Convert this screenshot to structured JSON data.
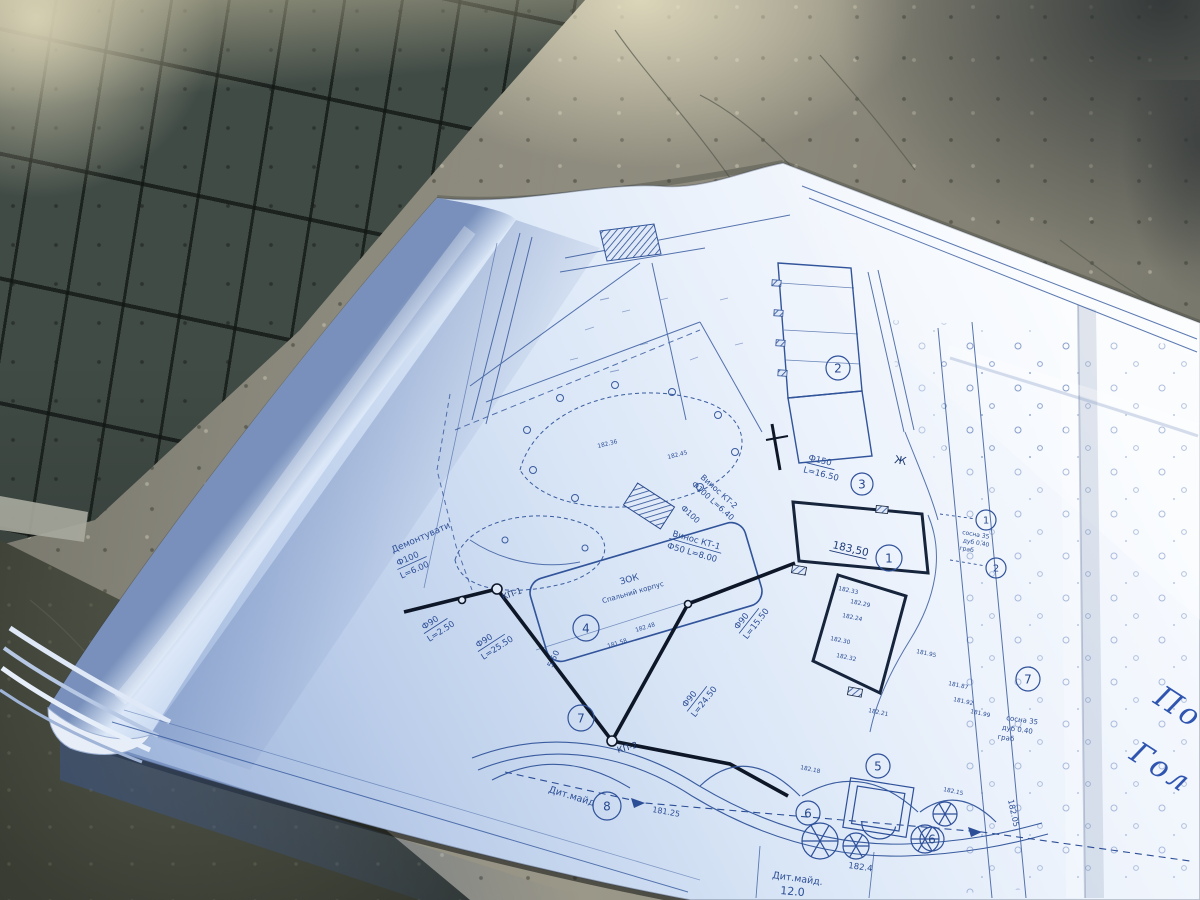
{
  "plan": {
    "labels": {
      "demolish": "Демонтувати",
      "p_f100": "Ф100",
      "p_f100_l": "L=6.00",
      "p_f90a": "Ф90",
      "p_f90a_l": "L=2.50",
      "p_f90b": "Ф90",
      "p_f90b_l": "L=25.50",
      "p_f90c": "Ф90",
      "p_f90c_l": "L=15.50",
      "p_f90d": "Ф90",
      "p_f90d_l": "L=24.50",
      "p_f150": "Ф150",
      "p_f150_l": "L=16.50",
      "outlet1": "Винос КТ-1",
      "outlet1_spec": "Ф50 L=8.00",
      "outlet2": "Винос КТ-2",
      "outlet2_spec": "Ф100 L=6.40",
      "outlet2_pipe": "Ф100",
      "kp1": "КП-1",
      "kp2": "КП-2",
      "zok1": "ЗОК",
      "zok2": "Спальний корпус",
      "bld_elev": "183,50",
      "well_zh": "Ж",
      "playground1": "Дит.майд",
      "playground2": "Дит.майд.",
      "dim12": "12.0",
      "dim550": "5.50",
      "lvl_18125": "181.25",
      "lvl_1824": "182.4",
      "lvl_18205": "182.05"
    },
    "legend": {
      "row1": "сосна 35",
      "row2": "дуб 0.40",
      "row3": "граб"
    },
    "callouts": [
      "1",
      "2",
      "3",
      "4",
      "5",
      "6",
      "6",
      "7",
      "7",
      "8",
      "1",
      "2"
    ],
    "elevations": [
      "182.33",
      "182.29",
      "182.24",
      "182.30",
      "182.32",
      "181.95",
      "181.87",
      "181.92",
      "181.99",
      "182.18",
      "182.15",
      "182.21",
      "182.36",
      "182.45",
      "181.58",
      "182.48"
    ],
    "handwriting": {
      "w1": "По",
      "w2": "Гол"
    }
  },
  "colors": {
    "paper_highlight": "#f7fafe",
    "paper_mid": "#ccdcf2",
    "paper_shadow": "#8fa8cf",
    "ink": "#35599e",
    "ink_dark": "#101b30",
    "pen": "#2f55b0",
    "concrete": "#8e8c7f",
    "tile_dark": "#47524c"
  }
}
